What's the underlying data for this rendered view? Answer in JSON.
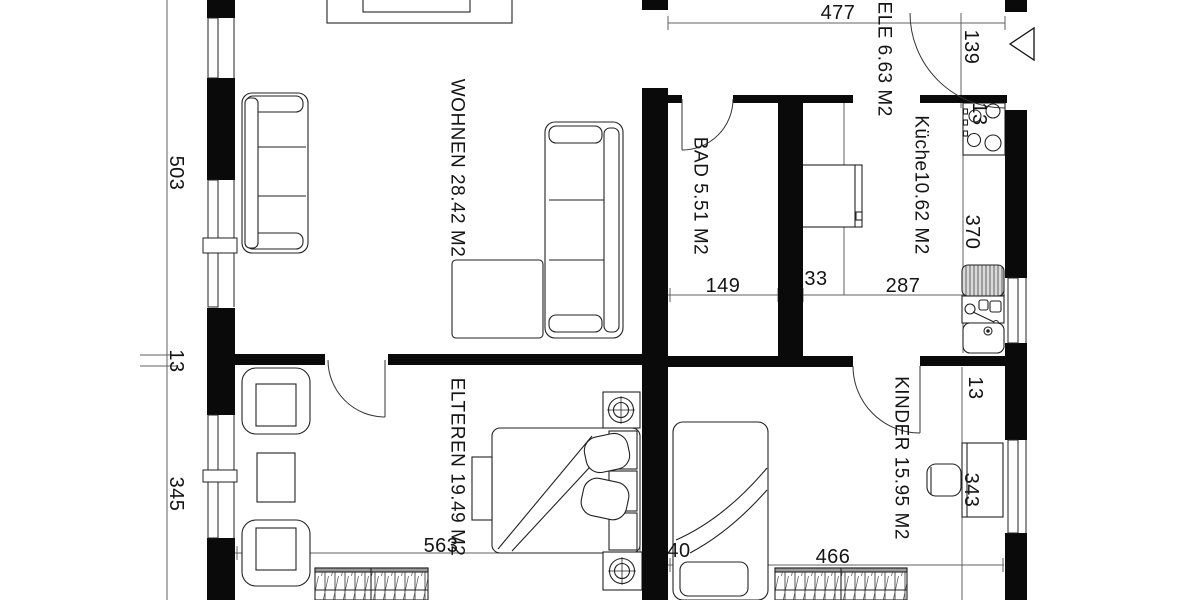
{
  "plan": {
    "rooms": {
      "wohnen": "WOHNEN 28.42 M2",
      "bad": "BAD 5.51 M2",
      "diele": "DELE 6.63 M2",
      "kueche": "Küche10.62 M2",
      "elteren": "ELTEREN 19.49 M2",
      "kinder": "KINDER 15.95 M2"
    },
    "dims": {
      "left_upper": "503",
      "left_wall": "13",
      "left_lower": "345",
      "hall_width": "477",
      "entry_opening": "139",
      "bad_width": "149",
      "bad_wall": "33",
      "kueche_width": "287",
      "kueche_depth": "370",
      "stove_width": "13",
      "kinder_wall": "13",
      "kinder_depth": "343",
      "elteren_width": "563",
      "door_wall": "40",
      "kinder_width": "466"
    }
  }
}
